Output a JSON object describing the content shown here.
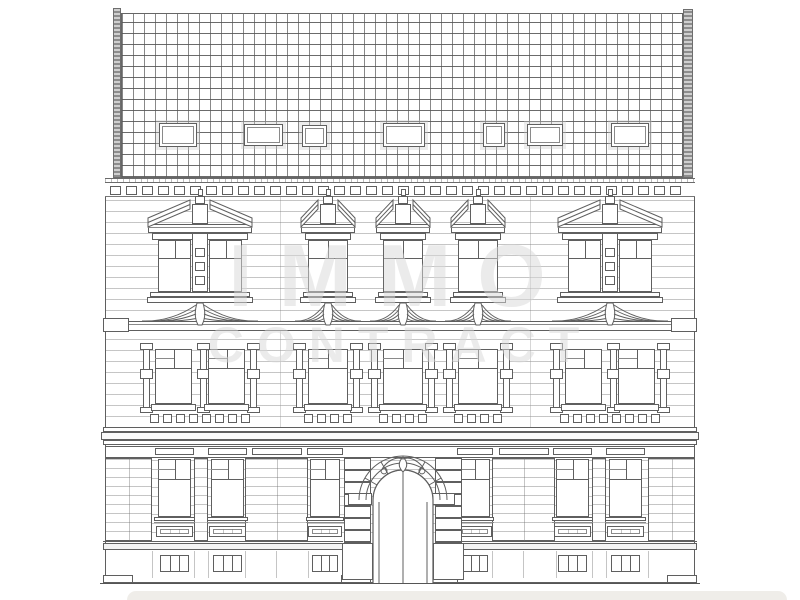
{
  "watermark": {
    "line1": "IMMO",
    "line2": "CONTRACT"
  },
  "palette": {
    "ink": "#5f5f5f",
    "faint_line": "#c9c9c9",
    "watermark_gray": "#d9d9d9",
    "banner": "#edebe7",
    "paper": "#ffffff"
  },
  "facade_geometry": {
    "extent": {
      "left": 105,
      "right": 695,
      "ground_y": 583
    },
    "roof": {
      "grid": {
        "x": 121,
        "y": 13,
        "w": 562,
        "h": 165,
        "cell": 11
      },
      "chimneys": [
        [
          113,
          8,
          8,
          170
        ],
        [
          683,
          9,
          10,
          169
        ]
      ],
      "skylights": [
        [
          159,
          123,
          38,
          24
        ],
        [
          244,
          124,
          39,
          22
        ],
        [
          302,
          125,
          25,
          22
        ],
        [
          383,
          123,
          42,
          24
        ],
        [
          483,
          123,
          22,
          24
        ],
        [
          527,
          124,
          36,
          22
        ],
        [
          611,
          123,
          38,
          24
        ]
      ]
    },
    "eave": {
      "x": 105,
      "y": 178,
      "w": 590,
      "h": 5
    },
    "dentils": {
      "y": 186,
      "h": 9,
      "w": 11,
      "pitch": 16,
      "x0": 110,
      "x1": 684,
      "band_y": 183,
      "band_h": 14
    },
    "upper_floor": {
      "wall": {
        "x": 105,
        "y": 197,
        "w": 590,
        "h": 124
      },
      "axes": [
        {
          "x": 155,
          "w": 90,
          "wide": true
        },
        {
          "x": 308,
          "w": 40
        },
        {
          "x": 383,
          "w": 40
        },
        {
          "x": 458,
          "w": 40
        },
        {
          "x": 565,
          "w": 90,
          "wide": true
        }
      ],
      "pediment_apex_y": 200,
      "entablature_y": 224,
      "frame_y": 240,
      "frame_h": 52,
      "transom_y": 258,
      "sill_y": 292,
      "swag_base_y": 321
    },
    "ledge": {
      "x": 105,
      "y": 321,
      "w": 590,
      "h": 10
    },
    "middle_floor": {
      "wall": {
        "x": 105,
        "y": 331,
        "w": 590,
        "h": 96
      },
      "window_y": 349,
      "window_h": 55,
      "transom_y": 368,
      "sill_y": 404,
      "panel_row_y": 414,
      "panel_sq": 9,
      "panel_pitch": 13
    },
    "mid_cornice": {
      "y": 427,
      "h": 18
    },
    "ground_floor": {
      "wall": {
        "x": 105,
        "y": 445,
        "w": 590,
        "h": 138
      },
      "lintel_y": 446,
      "lintel_h": 11,
      "windows": [
        [
          158,
          33
        ],
        [
          211,
          33
        ],
        [
          310,
          30
        ],
        [
          460,
          30
        ],
        [
          556,
          33
        ],
        [
          609,
          33
        ]
      ],
      "window_y": 459,
      "window_h": 58,
      "transom_y": 479,
      "sill_y": 517,
      "apron_y": 526,
      "apron_h": 11,
      "piers": [
        [
          105,
          47
        ],
        [
          194,
          14
        ],
        [
          245,
          63
        ],
        [
          492,
          63
        ],
        [
          592,
          14
        ],
        [
          648,
          47
        ]
      ],
      "sill_course_y": 541,
      "plinth_y": 551,
      "plinth_h": 27,
      "base_y": 578,
      "basement_window_y": 555,
      "basement_window_h": 17,
      "plinth_joints": [
        152,
        194,
        208,
        245,
        276,
        308,
        344,
        435,
        462,
        492,
        523,
        556,
        592,
        606,
        648
      ],
      "door": {
        "cx": 403,
        "opening_half_w": 30,
        "spring_y": 500,
        "arc_radii": [
          30,
          37,
          44
        ],
        "piers": [
          [
            344,
            27
          ],
          [
            435,
            27
          ]
        ],
        "pier_top_y": 458,
        "pier_block_h": 12,
        "impost_y": 493
      }
    },
    "axis_lines": {
      "xs": [
        280,
        530
      ],
      "y0": 197,
      "y1": 445
    }
  }
}
